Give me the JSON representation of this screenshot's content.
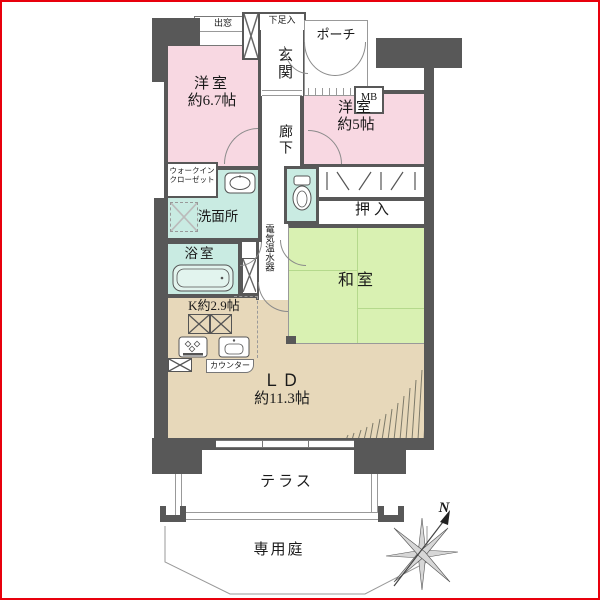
{
  "rooms": {
    "western1": {
      "name": "洋室",
      "size": "約6.7帖"
    },
    "western2": {
      "name": "洋室",
      "size": "約5帖"
    },
    "washitsu": {
      "name": "和室"
    },
    "ld": {
      "name": "ＬＤ",
      "size": "約11.3帖"
    },
    "kitchen": {
      "label": "K約2.9帖"
    },
    "corridor": {
      "name": "廊下"
    },
    "entrance": {
      "name": "玄関"
    },
    "porch": {
      "name": "ポーチ"
    },
    "washroom": {
      "name": "洗面所"
    },
    "bathroom": {
      "name": "浴室"
    },
    "oshiire": {
      "name": "押入"
    },
    "wic": {
      "line1": "ウォークイン",
      "line2": "クローゼット"
    },
    "terrace": {
      "name": "テラス"
    },
    "garden": {
      "name": "専用庭"
    }
  },
  "features": {
    "bay_window": "出窓",
    "shoe_cabinet": "下足入",
    "meter_box": "MB",
    "water_heater": "電気温水器",
    "counter": "カウンター",
    "compass_north": "N"
  },
  "colors": {
    "wall": "#585858",
    "room_pink": "#f8d8e2",
    "room_mint": "#c9ebe2",
    "room_green": "#d9f1b2",
    "floor_beige": "#e7d8ba",
    "outline": "#8a8a8a",
    "page_border": "#e8000d"
  }
}
